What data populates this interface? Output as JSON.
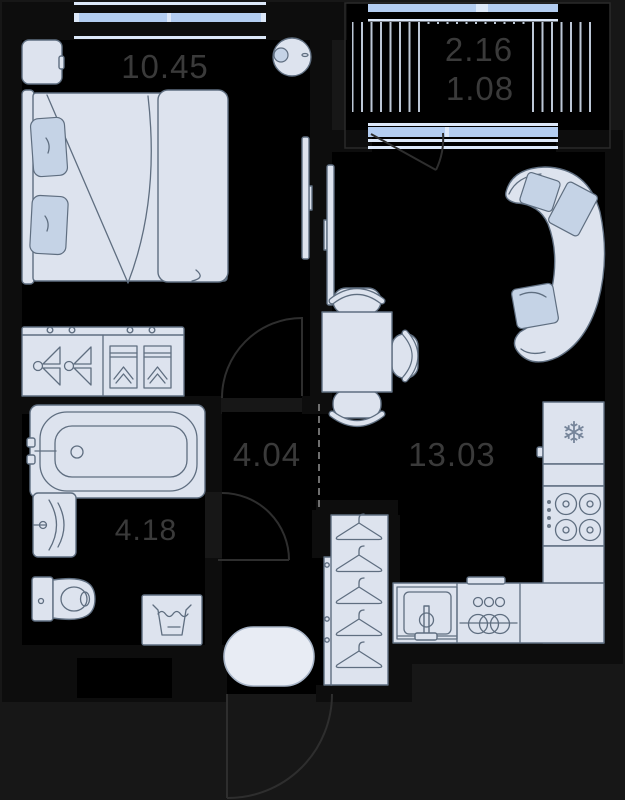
{
  "plan": {
    "rooms": {
      "bedroom": {
        "name": "bedroom",
        "area": "10.45"
      },
      "balcony": {
        "name": "balcony",
        "area_total": "2.16",
        "area_counted": "1.08"
      },
      "living_kitchen": {
        "name": "living-kitchen",
        "area": "13.03"
      },
      "hallway": {
        "name": "hallway",
        "area": "4.04"
      },
      "bathroom": {
        "name": "bathroom",
        "area": "4.18"
      }
    },
    "icons": {
      "snowflake": "❄"
    }
  },
  "colors": {
    "bg": "#171717",
    "wall": "#0d0d0d",
    "room": "#000000",
    "furniture_fill": "#dde3ee",
    "furniture_fill_light": "#e8ecf4",
    "accent_fill": "#c5d3e6",
    "furniture_stroke": "#5f6e80",
    "window_glass": "#b3cdf1",
    "window_frame": "#dce8f9",
    "hatch": "#bcc7d6",
    "label": "#3a3a3a",
    "door": "#2e2e2e",
    "dash": "#6e6e6e"
  }
}
